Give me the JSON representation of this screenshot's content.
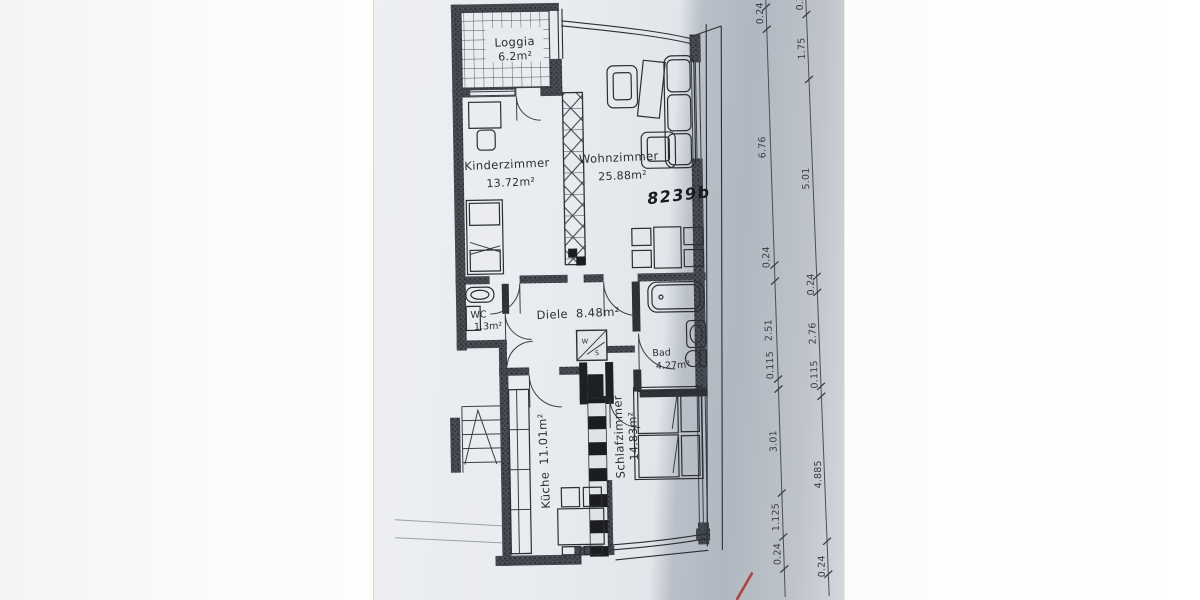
{
  "document": {
    "kind_label": "floor-plan-scan",
    "colors": {
      "paper": "#e5e8ec",
      "shadow": "#b3b9c2",
      "ink": "#2b2e33",
      "red_mark": "#a8332e"
    }
  },
  "rooms": {
    "loggia": {
      "name": "Loggia",
      "area": "6.2m²"
    },
    "kinderzimmer": {
      "name": "Kinderzimmer",
      "area": "13.72m²"
    },
    "wohnzimmer": {
      "name": "Wohnzimmer",
      "area": "25.88m²"
    },
    "wc": {
      "name": "WC",
      "area": "1.3m²"
    },
    "diele": {
      "name": "Diele",
      "area": "8.48m²"
    },
    "bad": {
      "name": "Bad",
      "area": "4.27m²"
    },
    "kueche": {
      "name": "Küche",
      "area": "11.01m²"
    },
    "schlafzimmer": {
      "name": "Schlafzimmer",
      "area": "14.83m²"
    }
  },
  "annotations": {
    "handwritten_number": "8239b",
    "shaft_w": "W",
    "shaft_s": "S"
  },
  "dimensions": {
    "inner_chain": [
      "0.24",
      "6.76",
      "0.24",
      "2.51",
      "0.115",
      "3.01",
      "1.125",
      "0.24"
    ],
    "outer_chain": [
      "0.2",
      "1.75",
      "5.01",
      "0.24",
      "2.76",
      "0.115",
      "4.885",
      "0.24"
    ]
  }
}
